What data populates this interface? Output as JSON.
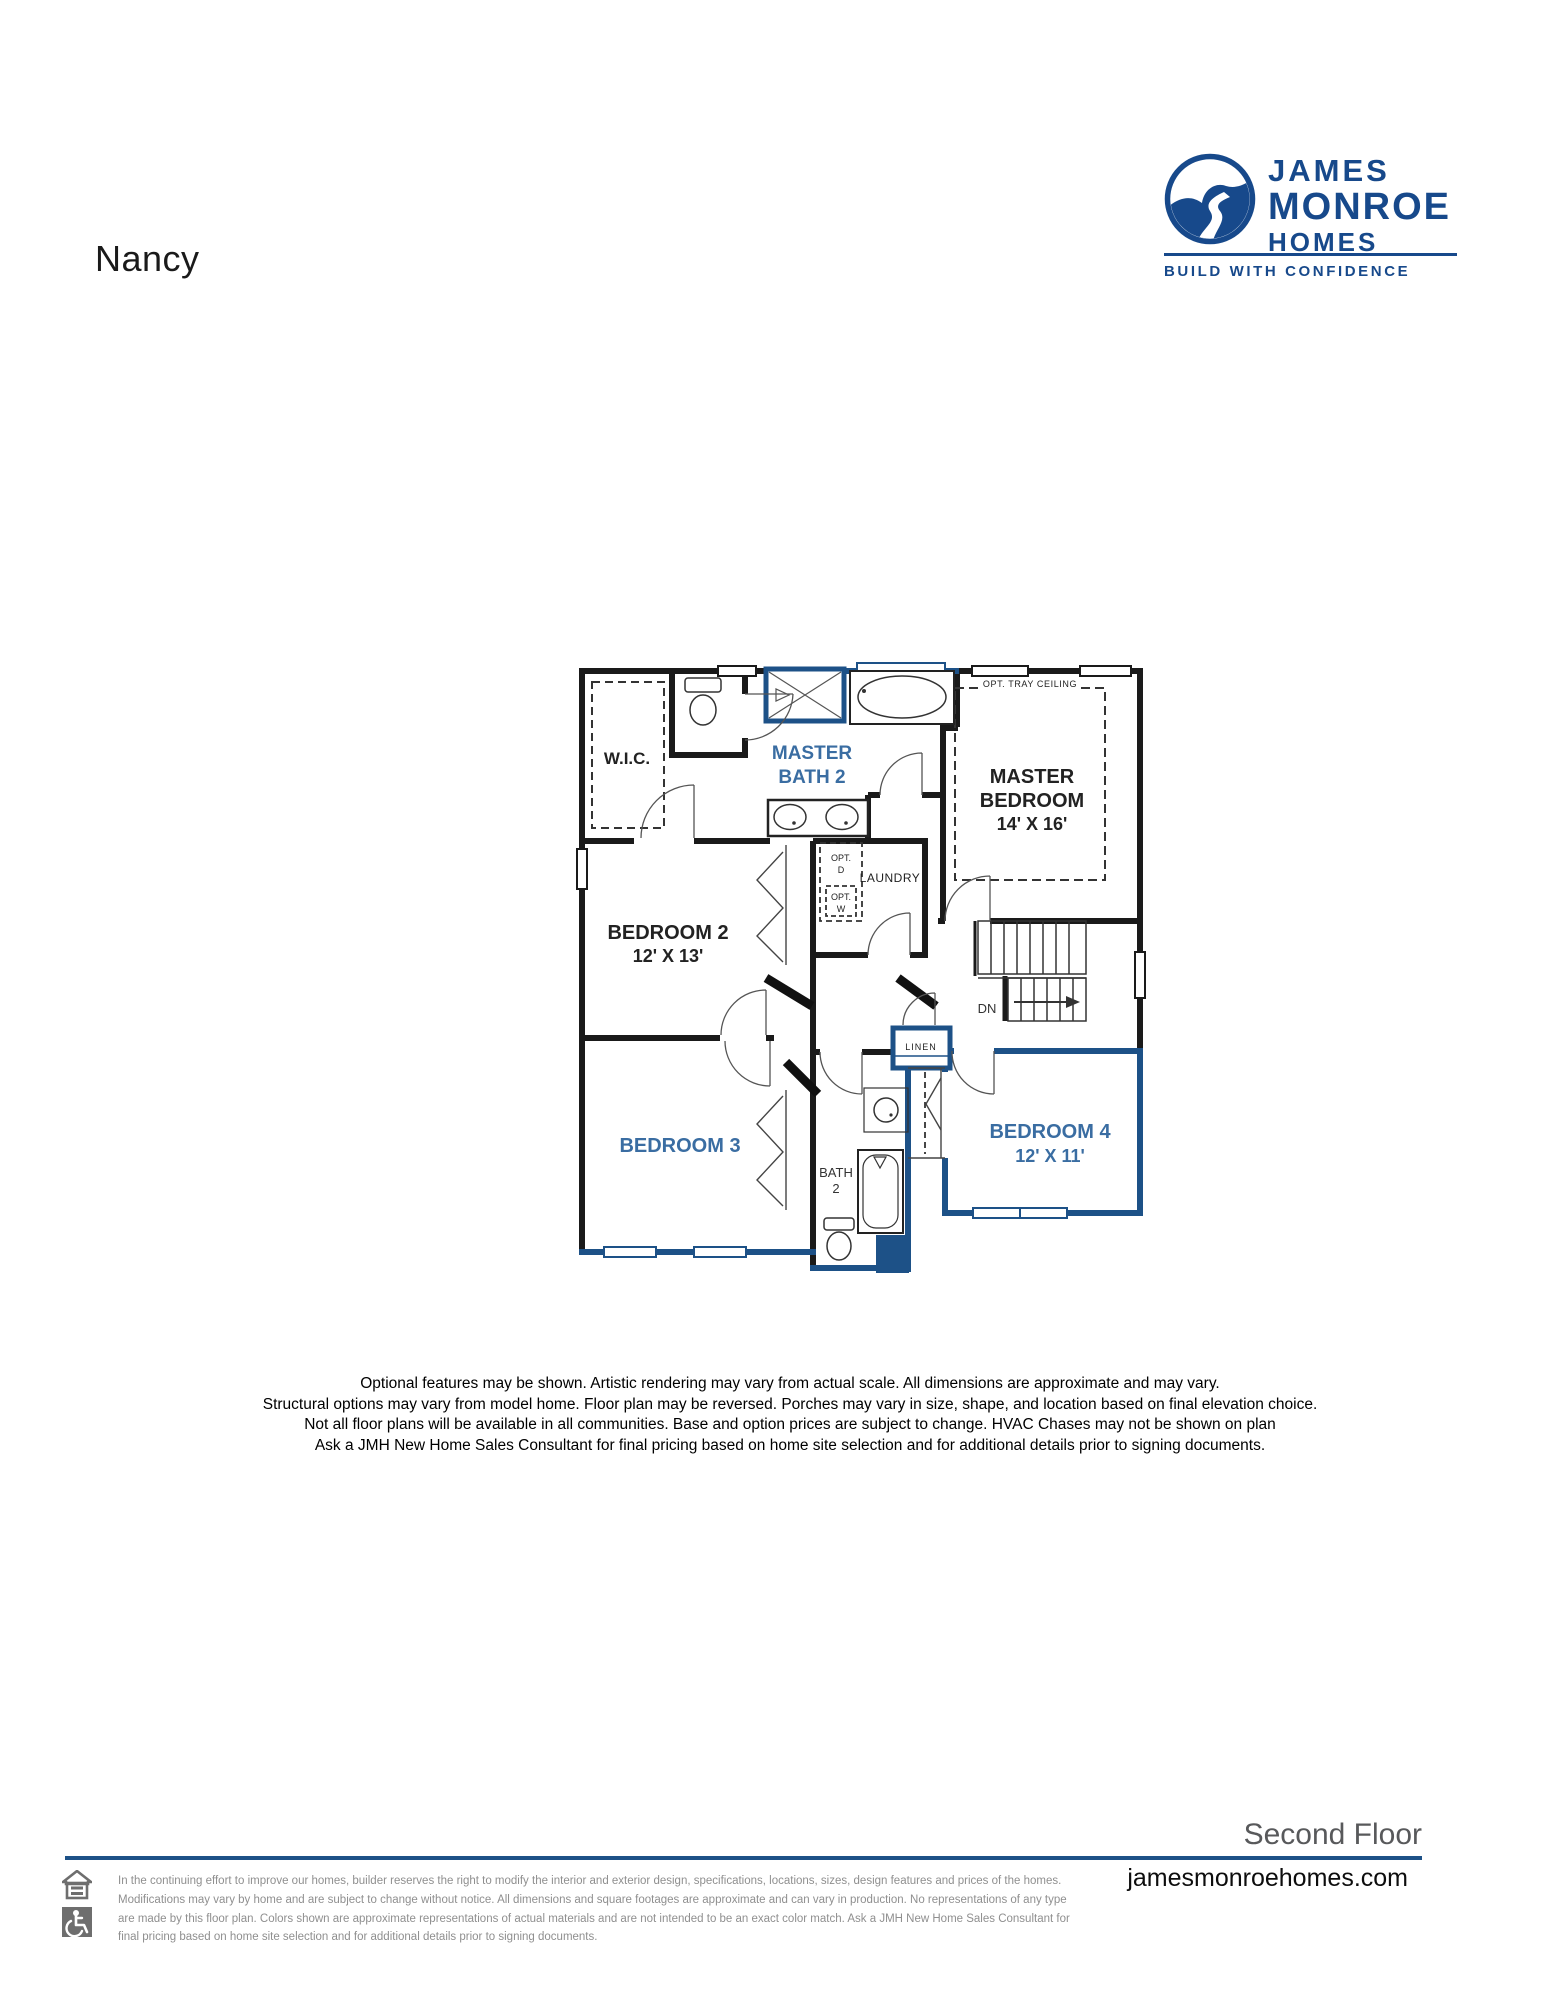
{
  "document": {
    "plan_name": "Nancy",
    "floor_label": "Second Floor",
    "website": "jamesmonroehomes.com"
  },
  "logo": {
    "emblem": "river-landscape-icon",
    "name_line1": "JAMES",
    "name_line2": "MONROE",
    "name_line3": "HOMES",
    "tagline": "BUILD WITH CONFIDENCE",
    "brand_color": "#17498b"
  },
  "floor_plan": {
    "wall_colors": {
      "standard": "#1a1a1a",
      "accent_blue": "#1d5187"
    },
    "label_accent_color": "#3a6da2",
    "rooms": {
      "wic": {
        "label": "W.I.C."
      },
      "master_bath": {
        "line1": "MASTER",
        "line2": "BATH 2"
      },
      "master_bedroom": {
        "line1": "MASTER",
        "line2": "BEDROOM",
        "dims": "14' X 16'"
      },
      "bedroom2": {
        "label": "BEDROOM 2",
        "dims": "12' X 13'"
      },
      "bedroom3": {
        "label": "BEDROOM 3"
      },
      "bedroom4": {
        "label": "BEDROOM 4",
        "dims": "12' X 11'"
      },
      "bath2": {
        "line1": "BATH",
        "line2": "2"
      },
      "laundry": {
        "label": "LAUNDRY"
      },
      "linen": {
        "label": "LINEN"
      }
    },
    "annotations": {
      "tray_ceiling": "OPT. TRAY CEILING",
      "opt_dryer": {
        "line1": "OPT.",
        "line2": "D"
      },
      "opt_washer": {
        "line1": "OPT.",
        "line2": "W"
      },
      "stairs_down": "DN"
    },
    "fixtures": [
      "toilet",
      "walk-in-shower",
      "bathtub",
      "double-vanity-sinks",
      "washer-dryer-optional",
      "stairs-down",
      "sink",
      "tub",
      "toilet",
      "closet-bifold-doors",
      "windows"
    ]
  },
  "disclaimer": {
    "lines": [
      "Optional features may be shown. Artistic rendering may vary from actual scale. All dimensions are approximate and may vary.",
      "Structural options may vary from model home. Floor plan may be reversed. Porches may vary in size, shape, and location based on final elevation choice.",
      "Not all floor plans will be available in all communities. Base and option prices are subject to change. HVAC Chases may not be shown on plan",
      "Ask a JMH New Home Sales Consultant for final pricing based on home site selection and for additional details prior to signing documents."
    ]
  },
  "footer": {
    "icons": [
      "equal-housing-icon",
      "accessibility-icon"
    ],
    "rule_color": "#1d5187",
    "fine_print_lines": [
      "In the continuing effort to improve our homes, builder reserves the right to modify the interior and exterior design, specifications, locations, sizes, design features and prices of the homes.",
      "Modifications may vary by home and are subject to change without notice. All dimensions and square footages are approximate and can vary in production. No representations of any type",
      "are made by this floor plan. Colors shown are approximate representations of actual materials and are not intended to be an exact color match. Ask a JMH New Home Sales Consultant for",
      "final pricing based on home site selection and for additional details prior to signing documents."
    ]
  }
}
